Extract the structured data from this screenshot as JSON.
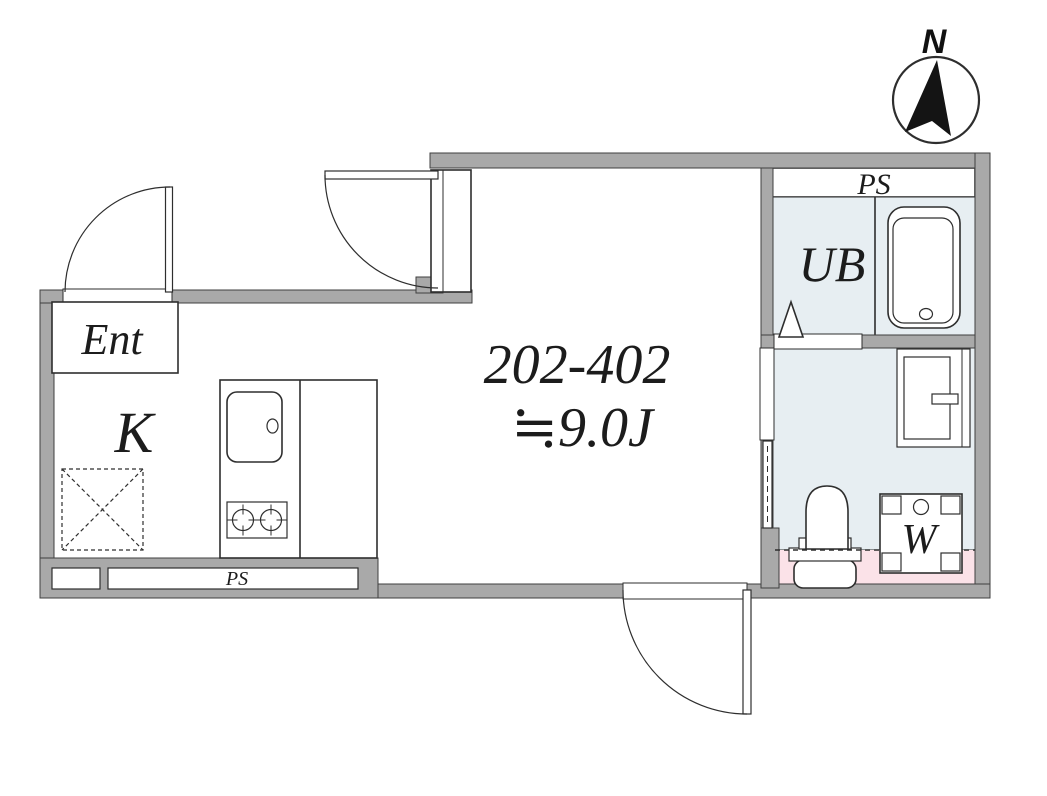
{
  "colors": {
    "wall": "#a9a9a9",
    "wall_edge": "#3f3f3f",
    "line": "#2e2e2e",
    "room_blue": "#e7eef2",
    "accent_pink": "#fbe2e8",
    "needle_black": "#141414"
  },
  "compass": {
    "north_label": "N"
  },
  "labels": {
    "ps_top": "PS",
    "unit_bath": "UB",
    "entrance": "Ent",
    "kitchen": "K",
    "unit_range": "202-402",
    "area": "≒9.0J",
    "washer": "W",
    "ps_bottom": "PS"
  }
}
